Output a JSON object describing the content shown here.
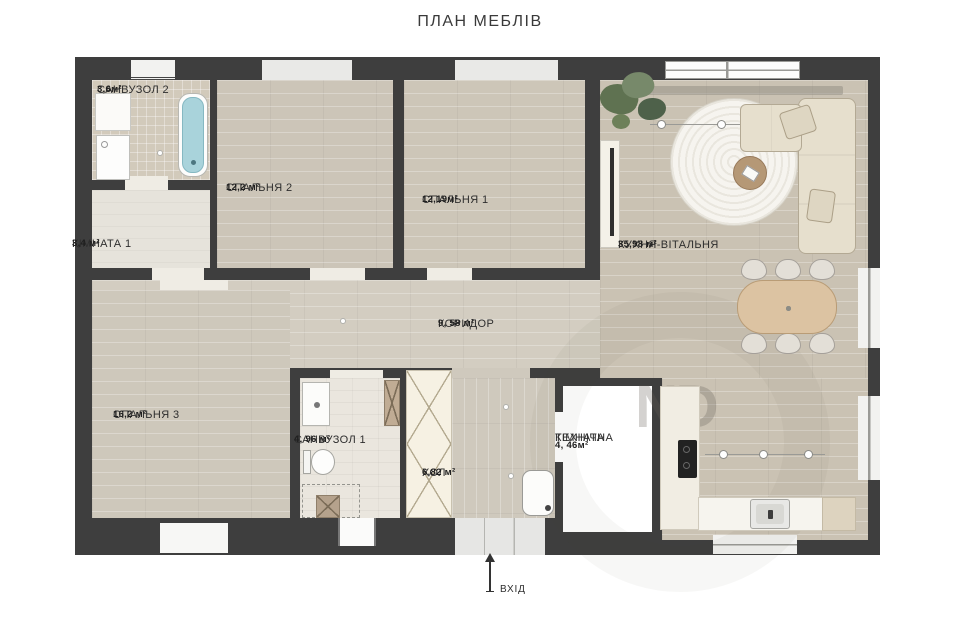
{
  "title": "ПЛАН МЕБЛІВ",
  "rooms": {
    "sanvuzol2": {
      "name": "САНВУЗОЛ 2",
      "area": "3,6м²"
    },
    "kimnata1": {
      "name": "КІМНАТА 1",
      "area": "3,4 м²"
    },
    "spalnya2": {
      "name": "СПАЛЬНЯ 2",
      "area": "12,2 м²"
    },
    "spalnya1": {
      "name": "СПАЛЬНЯ 1",
      "area": "12,19м²"
    },
    "kukhnya": {
      "name": "КУХНЯ-ВІТАЛЬНЯ",
      "area": "35,98 м²"
    },
    "korydor": {
      "name": "КОРИДОР",
      "area": "9, 58 м²"
    },
    "spalnya3": {
      "name": "СПАЛЬНЯ 3",
      "area": "16,2 м²"
    },
    "sanvuzol1": {
      "name": "САНВУЗОЛ 1",
      "area": "4, 96 м²"
    },
    "khol": {
      "name": "ХОЛ",
      "area": "6,82 м²"
    },
    "tekhnichna": {
      "name_line1": "ТЕХНІЧНА",
      "name_line2": "КІМНАТА",
      "area": "4, 46м²"
    }
  },
  "entrance": {
    "label": "ВХІД"
  },
  "watermark": {
    "text": "ND"
  },
  "colors": {
    "wall": "#3e3e3e",
    "wood_floor": "#ccc5b7",
    "bathtub_blue": "#a9d3db",
    "green_mat": "#9ccfa3",
    "sofa_beige": "#e6dfcd",
    "dining_table_wood": "#dcc3a2",
    "tech_room_white": "#ffffff"
  }
}
